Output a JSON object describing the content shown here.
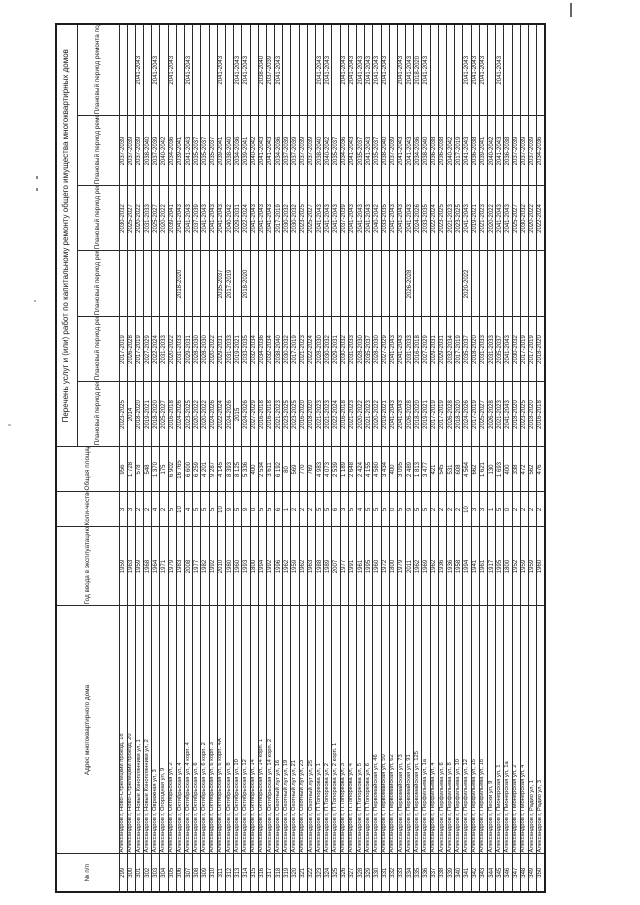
{
  "document": {
    "kind": "Постановление/реестр — перечень работ по капитальному ремонту (скан, повёрнут на 90°)",
    "orientation": "rotated-90-ccw"
  },
  "table": {
    "title": "Перечень услуг и (или) работ по капитальному ремонту общего имущества многоквартирных домов",
    "columns": {
      "num": "№ п/п",
      "address": "Адрес многоквартирного дома",
      "year": "Год ввода в эксплуатацию",
      "floors": "Коли-чество этажей",
      "area": "Общая площадь",
      "roof": "Плановый период ремонта крыши",
      "vis": "Плановый период ремонта ВИС",
      "lift": "Плановый период ремонта лифтов",
      "facade": "Плановый период ремонта фасада",
      "foundation": "Плановый период ремонта фундамента",
      "basement": "Плановый период ремонта подвала"
    },
    "rows": [
      [
        "299",
        "Александров г, Ново-Стрелецкий проезд, 18",
        "1959",
        "3",
        "956",
        "2023-2025",
        "2017-2019",
        "",
        "2030-2032",
        "2037-2039",
        ""
      ],
      [
        "300",
        "Александров г, Ново-Стрелецкий проезд, 20",
        "1963",
        "3",
        "1 728",
        "2014",
        "2026-2028",
        "",
        "2025-2027",
        "2037-2039",
        ""
      ],
      [
        "301",
        "Александров г, Новые Коноплянники ул, 1",
        "1959",
        "2",
        "578",
        "2018-2020",
        "2017-2019",
        "",
        "2020-2022",
        "2037-2039",
        "2041-2043"
      ],
      [
        "302",
        "Александров г, Новые Коноплянники ул, 2",
        "1968",
        "2",
        "548",
        "2019-2021",
        "2027-2029",
        "",
        "2031-2033",
        "2038-2040",
        ""
      ],
      [
        "303",
        "Александров г, Овражная ул, 3",
        "1964",
        "4",
        "1 370",
        "2018-2020",
        "2022-2024",
        "",
        "2025-2027",
        "2037-2039",
        "2041-2043"
      ],
      [
        "304",
        "Александров г, Огородная ул, 9",
        "1971",
        "2",
        "175",
        "2025-2027",
        "2031-2033",
        "",
        "2020-2022",
        "2040-2042",
        ""
      ],
      [
        "305",
        "Александров г, Октябрьская ул, 2",
        "1979",
        "5",
        "6 902",
        "2016-2018",
        "2020-2022",
        "",
        "2039-2041",
        "2034-2036",
        "2041-2043"
      ],
      [
        "306",
        "Александров г, Октябрьская ул, 4",
        "1983",
        "10",
        "16 765",
        "2024-2026",
        "2031-2033",
        "2018-2020",
        "2041-2043",
        "2039-2041",
        ""
      ],
      [
        "307",
        "Александров г, Октябрьская ул, 4 корп. 4",
        "2008",
        "4",
        "6 600",
        "2023-2025",
        "2029-2031",
        "",
        "2041-2043",
        "2041-2043",
        "2041-2043"
      ],
      [
        "308",
        "Александров г, Октябрьская ул, 6",
        "1977",
        "5",
        "6 259",
        "2020-2022",
        "2028-2030",
        "",
        "2037-2039",
        "2035-2037",
        ""
      ],
      [
        "309",
        "Александров г, Октябрьская ул, 6 корп. 2",
        "1982",
        "5",
        "4 201",
        "2020-2022",
        "2028-2030",
        "",
        "2041-2043",
        "2035-2037",
        ""
      ],
      [
        "310",
        "Александров г, Октябрьская ул, 6 корп. 3",
        "1992",
        "5",
        "9 287",
        "2024-2026",
        "2020-2022",
        "",
        "2041-2043",
        "2035-2037",
        ""
      ],
      [
        "311",
        "Александров г, Октябрьская ул, 6 корп. 4А",
        "2010",
        "10",
        "4 145",
        "2022-2024",
        "2029-2031",
        "2035-2037",
        "2041-2043",
        "2039-2041",
        "2041-2043"
      ],
      [
        "312",
        "Александров г, Октябрьская ул, 8",
        "1980",
        "9",
        "8 393",
        "2024-2026",
        "2031-2033",
        "2017-2019",
        "2040-2042",
        "2038-2040",
        ""
      ],
      [
        "313",
        "Александров г, Октябрьская ул, 10",
        "1960",
        "5",
        "8 125",
        "2015",
        "2019-2021",
        "",
        "2029-2031",
        "2034-2036",
        "2041-2043"
      ],
      [
        "314",
        "Александров г, Октябрьская ул, 12",
        "1993",
        "9",
        "5 336",
        "2024-2026",
        "2033-2035",
        "2018-2020",
        "2022-2024",
        "2039-2041",
        "2041-2043"
      ],
      [
        "315",
        "Александров г, Октябрьская ул, 14",
        "1800",
        "0",
        "400",
        "2027-2029",
        "2032-2034",
        "",
        "2041-2043",
        "2040-2042",
        ""
      ],
      [
        "316",
        "Александров г, Октябрьская ул, 14 корп. 1",
        "1994",
        "5",
        "2 534",
        "2016-2018",
        "2034-2036",
        "",
        "2041-2043",
        "2041-2043",
        "2038-2040"
      ],
      [
        "317",
        "Александров г, Октябрьская ул, 14 корп. 2",
        "1992",
        "5",
        "3 611",
        "2016-2018",
        "2032-2034",
        "",
        "2041-2043",
        "2041-2043",
        "2037-2039"
      ],
      [
        "318",
        "Александров г, Охотный луг ул, 16",
        "1996",
        "6",
        "6 192",
        "2021-2023",
        "2038-2040",
        "",
        "2017-2019",
        "2034-2036",
        "2041-2043"
      ],
      [
        "319",
        "Александров г, Охотный луг ул, 19",
        "1962",
        "1",
        "80",
        "2023-2025",
        "2030-2032",
        "",
        "2030-2032",
        "2037-2039",
        ""
      ],
      [
        "320",
        "Александров г, Охотный луг ул, 21",
        "1959",
        "2",
        "569",
        "2023-2025",
        "2017-2019",
        "",
        "2030-2032",
        "2037-2039",
        ""
      ],
      [
        "321",
        "Александров г, Охотный луг ул, 23",
        "1962",
        "2",
        "770",
        "2016-2020",
        "2021-2023",
        "",
        "2023-2025",
        "2037-2039",
        ""
      ],
      [
        "322",
        "Александров г, Охотный луг ул, 25",
        "1963",
        "2",
        "769",
        "2018-2020",
        "2022-2024",
        "",
        "2025-2027",
        "2037-2039",
        ""
      ],
      [
        "323",
        "Александров г, П.Топоркова ул, 1",
        "1988",
        "5",
        "4 983",
        "2021-2023",
        "2028-2030",
        "",
        "2041-2043",
        "2038-2040",
        "2041-2043"
      ],
      [
        "324",
        "Александров г, П.Топоркова ул, 2",
        "1989",
        "5",
        "4 073",
        "2021-2023",
        "2030-2032",
        "",
        "2041-2043",
        "2040-2042",
        "2041-2043"
      ],
      [
        "325",
        "Александров г, П.Топоркова ул, 2 корп. 1",
        "2007",
        "6",
        "2 539",
        "2022-2024",
        "2029-2031",
        "",
        "2041-2043",
        "2035-2037",
        ""
      ],
      [
        "326",
        "Александров г, П.Топоркова ул, 3",
        "1977",
        "3",
        "1 189",
        "2016-2018",
        "2030-2032",
        "",
        "2037-2039",
        "2034-2036",
        "2041-2043"
      ],
      [
        "327",
        "Александров г, П.Топоркова ул, 4",
        "1991",
        "5",
        "2 648",
        "2021-2023",
        "2031-2033",
        "",
        "2041-2043",
        "2041-2043",
        "2041-2043"
      ],
      [
        "328",
        "Александров г, П.Топоркова ул, 5",
        "1961",
        "4",
        "2 424",
        "2020-2022",
        "2028-2030",
        "",
        "2041-2043",
        "2035-2037",
        "2041-2043"
      ],
      [
        "329",
        "Александров г, П.Топоркова ул, 6",
        "1995",
        "5",
        "4 155",
        "2021-2023",
        "2035-2037",
        "",
        "2041-2043",
        "2041-2043",
        "2041-2043"
      ],
      [
        "330",
        "Александров г, Первомайская ул, 46",
        "1960",
        "5",
        "4 580",
        "2020-2022",
        "2028-2030",
        "",
        "2040-2042",
        "2035-2037",
        "2041-2043"
      ],
      [
        "331",
        "Александров г, Первомайская ул, 50",
        "1972",
        "5",
        "3 434",
        "2019-2021",
        "2027-2029",
        "",
        "2033-2035",
        "2038-2040",
        "2041-2043"
      ],
      [
        "332",
        "Александров г, Первомайская ул, 62",
        "1800",
        "0",
        "400",
        "2041-2043",
        "2041-2043",
        "",
        "2041-2043",
        "2037-2039",
        ""
      ],
      [
        "333",
        "Александров г, Первомайская ул, 73",
        "1979",
        "5",
        "3 095",
        "2041-2043",
        "2041-2043",
        "",
        "2041-2043",
        "2041-2043",
        "2041-2043"
      ],
      [
        "334",
        "Александров г, Первомайская ул, 91",
        "2011",
        "9",
        "2 489",
        "2026-2028",
        "2031-2033",
        "2026-2028",
        "2041-2043",
        "2041-2043",
        "2041-2043"
      ],
      [
        "335",
        "Александров г, Первомайская ул, 125",
        "1962",
        "5",
        "1 813",
        "2018-2020",
        "2016-2018",
        "",
        "2024-2026",
        "2034-2036",
        "2018-2020"
      ],
      [
        "336",
        "Александров г, Перфильева ул, 1а",
        "1969",
        "5",
        "3 477",
        "2019-2021",
        "2027-2029",
        "",
        "2033-2035",
        "2038-2040",
        "2041-2043"
      ],
      [
        "337",
        "Александров г, Перфильева ул, 4",
        "1962",
        "2",
        "421",
        "2017-2019",
        "2029-2031",
        "",
        "2022-2024",
        "2036-2038",
        ""
      ],
      [
        "338",
        "Александров г, Перфильева ул, 6",
        "1936",
        "2",
        "545",
        "2017-2019",
        "2029-2031",
        "",
        "2023-2025",
        "2036-2038",
        ""
      ],
      [
        "339",
        "Александров г, Перфильева ул, 8",
        "1936",
        "2",
        "531",
        "2026-2028",
        "2032-2034",
        "",
        "2021-2023",
        "2040-2042",
        ""
      ],
      [
        "340",
        "Александров г, Перфильева ул, 10",
        "1958",
        "2",
        "608",
        "2018-2020",
        "2017-2019",
        "",
        "2023-2025",
        "2017-2019",
        ""
      ],
      [
        "341",
        "Александров г, Перфильева ул, 12",
        "1994",
        "10",
        "4 564",
        "2024-2026",
        "2035-2037",
        "2020-2022",
        "2041-2043",
        "2041-2043",
        "2041-2043"
      ],
      [
        "342",
        "Александров г, Перфильева ул, 15",
        "1941",
        "3",
        "662",
        "2017-2019",
        "2018-2020",
        "",
        "2019-2021",
        "2036-2038",
        "2041-2043"
      ],
      [
        "343",
        "Александров г, Перфильева ул, 18",
        "1961",
        "3",
        "1 621",
        "2025-2027",
        "2031-2033",
        "",
        "2021-2023",
        "2039-2041",
        "2041-2043"
      ],
      [
        "344",
        "Александров г, Пески ул, 9",
        "1917",
        "1",
        "130",
        "2026-2028",
        "2031-2033",
        "",
        "2020-2022",
        "2040-2042",
        ""
      ],
      [
        "345",
        "Александров г, Пионерская ул, 1",
        "1995",
        "5",
        "1 693",
        "2021-2023",
        "2035-2037",
        "",
        "2041-2043",
        "2041-2043",
        "2041-2043"
      ],
      [
        "346",
        "Александров г, Пионерская ул, 1а",
        "1800",
        "0",
        "400",
        "2041-2043",
        "2041-2043",
        "",
        "2041-2043",
        "2036-2038",
        ""
      ],
      [
        "347",
        "Александров г, Пионерская ул, 2",
        "1952",
        "2",
        "338",
        "2018-2020",
        "2030-2032",
        "",
        "2025-2027",
        "2037-2039",
        ""
      ],
      [
        "348",
        "Александров г, Пионерская ул, 4",
        "1959",
        "2",
        "472",
        "2023-2025",
        "2017-2019",
        "",
        "2030-2032",
        "2037-2039",
        ""
      ],
      [
        "349",
        "Александров г, Радио ул, 1",
        "1959",
        "2",
        "562",
        "2018-2020",
        "2017-2019",
        "",
        "2020-2022",
        "2037-2039",
        ""
      ],
      [
        "350",
        "Александров г, Радио ул, 3",
        "1960",
        "2",
        "476",
        "2016-2018",
        "2018-2020",
        "",
        "2022-2024",
        "2034-2036",
        ""
      ]
    ]
  }
}
